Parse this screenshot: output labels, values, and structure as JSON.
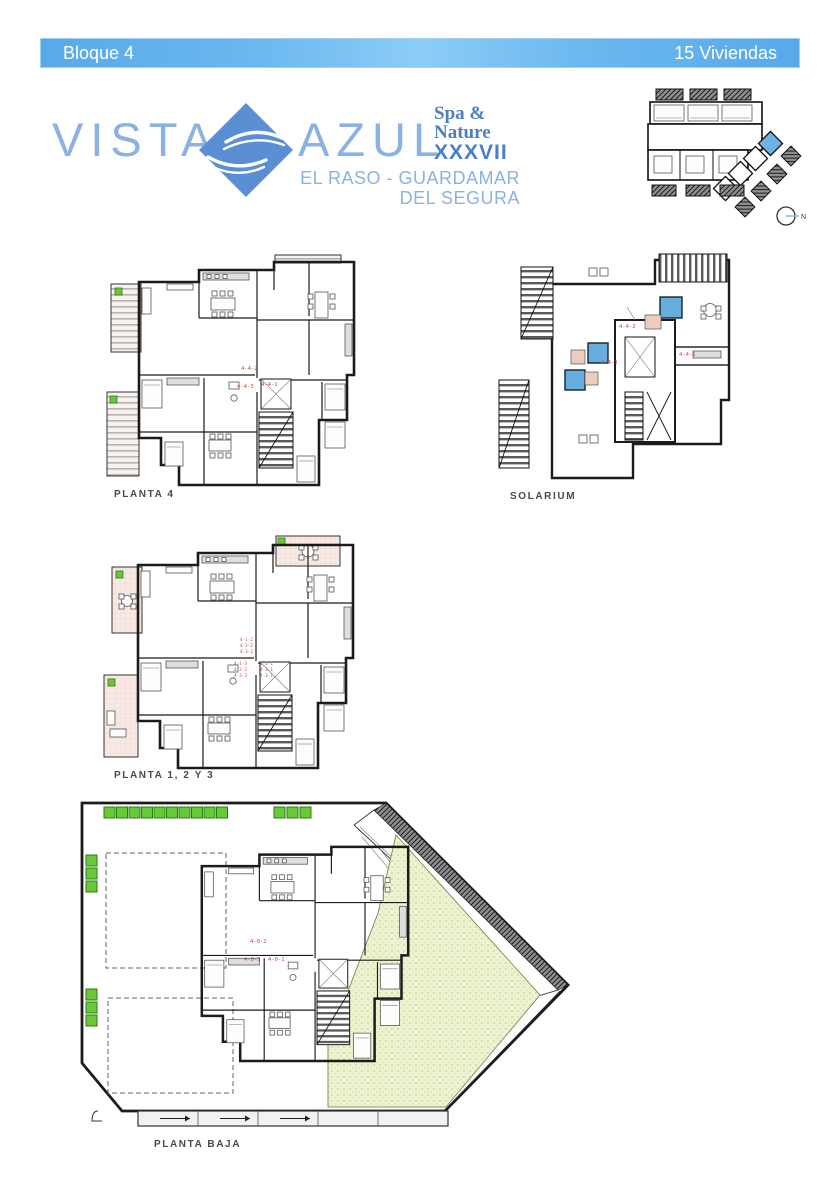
{
  "header": {
    "left": "Bloque 4",
    "right": "15 Viviendas"
  },
  "logo": {
    "word1": "VISTA",
    "word2": "AZUL",
    "tagline1": "Spa &",
    "tagline2": "Nature",
    "tagline3": "XXXVII",
    "location1": "EL RASO - GUARDAMAR",
    "location2": "DEL SEGURA"
  },
  "siteplan": {
    "compass_label": "N"
  },
  "plans": {
    "planta4": {
      "label": "PLANTA 4",
      "units": [
        "4-4-2",
        "4-4-3",
        "4-4-1"
      ]
    },
    "solarium": {
      "label": "SOLARIUM",
      "units": [
        "4-4-2",
        "4-4-3",
        "4-4-1"
      ]
    },
    "planta123": {
      "label": "PLANTA 1, 2 Y 3",
      "units": [
        "4-1-2",
        "4-2-2",
        "4-3-2",
        "4-1-3",
        "4-2-3",
        "4-3-3",
        "4-1-1",
        "4-2-1",
        "4-3-1"
      ]
    },
    "plantabaja": {
      "label": "PLANTA BAJA",
      "units": [
        "4-0-2",
        "4-0-3",
        "4-0-1"
      ]
    }
  },
  "colors": {
    "header_blue": "#5FAFEC",
    "logo_light_blue": "#8AB2E2",
    "brand_blue": "#4C7FC2",
    "diamond_blue": "#5B8FD3",
    "terrace_pink": "#F8E9E4",
    "garden_green": "#EDF3D2",
    "bush_green": "#68C938",
    "pool_blue": "#67AEDE",
    "unit_label_red": "#C44A44"
  }
}
